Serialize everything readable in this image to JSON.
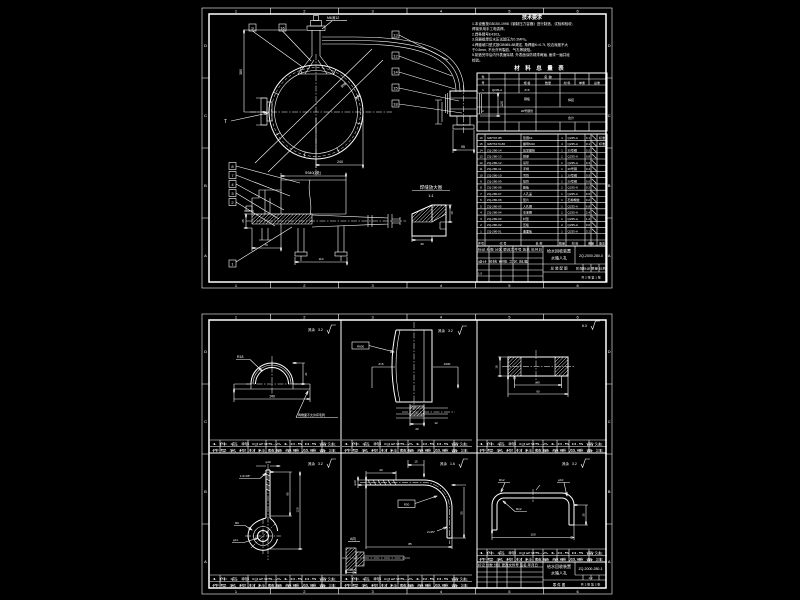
{
  "app": {
    "background": "#000000",
    "line_color": "#ffffff"
  },
  "zones": {
    "h": [
      "1",
      "2",
      "3",
      "4",
      "5",
      "6"
    ],
    "v": [
      "D",
      "C",
      "B",
      "A"
    ]
  },
  "sheet1": {
    "notes": {
      "title": "技术要求",
      "lines": [
        "1.本设备按GB150-1998《钢制压力容器》进行制造、试验和验收;",
        "  焊接采用手工电弧焊。",
        "2.焊条牌号E4303。",
        "3.容器组焊后水压试验压力0.2MPa。",
        "4.焊缝坡口型式按GB985-88规定, 角焊缝K=0.7t, 咬边深度不大",
        "  于0.5mm, 不允许有裂纹、气孔等缺陷。",
        "5.制造完毕后内外表面除锈, 外表面涂防锈漆两遍, 面漆一遍并经",
        "  检验。"
      ]
    },
    "table_title": "材 料 总 量 表",
    "table1": {
      "cells": [
        "件",
        "号",
        "名  称",
        "规 格",
        "数量",
        "材 料",
        "单重",
        "总重",
        "1",
        "Q235-A",
        "δ=6",
        "钢板",
        "焊接",
        "2",
        "20号钢管",
        "合计"
      ]
    },
    "bom": {
      "header": {
        "n": "件号",
        "code": "代  号",
        "name": "名  称",
        "qty": "数量",
        "mat": "材  料",
        "wt": "重量",
        "rem": "备注"
      },
      "rows": [
        {
          "n": "16",
          "code": "GB/T97-85",
          "name": "垫圈10",
          "qty": "4",
          "mat": "Q235-A",
          "w": "0.1",
          "rem": "标准"
        },
        {
          "n": "15",
          "code": "GB/T6170-86",
          "name": "螺母M10",
          "qty": "4",
          "mat": "Q235-A",
          "w": "0.1",
          "rem": "标准"
        },
        {
          "n": "14",
          "code": "ZQ-280-14",
          "name": "压紧螺栓",
          "qty": "1",
          "mat": "35号钢",
          "w": "0.2",
          "rem": ""
        },
        {
          "n": "13",
          "code": "ZQ-280-13",
          "name": "横梁",
          "qty": "1",
          "mat": "Q235-A",
          "w": "0.8",
          "rem": ""
        },
        {
          "n": "12",
          "code": "ZQ-280-12",
          "name": "吊环",
          "qty": "1",
          "mat": "Q235-A",
          "w": "0.3",
          "rem": ""
        },
        {
          "n": "11",
          "code": "ZQ-280-11",
          "name": "手柄",
          "qty": "1",
          "mat": "20号钢",
          "w": "0.4",
          "rem": ""
        },
        {
          "n": "10",
          "code": "ZQ-280-10",
          "name": "弯管",
          "qty": "1",
          "mat": "20号钢",
          "w": "0.5",
          "rem": ""
        },
        {
          "n": "9",
          "code": "ZQ-280-09",
          "name": "接管",
          "qty": "1",
          "mat": "20号钢",
          "w": "0.6",
          "rem": ""
        },
        {
          "n": "8",
          "code": "ZQ-280-08",
          "name": "筋板",
          "qty": "2",
          "mat": "Q235-A",
          "w": "0.2",
          "rem": ""
        },
        {
          "n": "7",
          "code": "ZQ-280-07",
          "name": "人孔盖",
          "qty": "1",
          "mat": "Q235-A",
          "w": "9.5",
          "rem": ""
        },
        {
          "n": "6",
          "code": "ZQ-280-06",
          "name": "垫片",
          "qty": "1",
          "mat": "石棉橡胶",
          "w": "0.2",
          "rem": ""
        },
        {
          "n": "5",
          "code": "ZQ-280-05",
          "name": "人孔圈",
          "qty": "1",
          "mat": "Q235-A",
          "w": "6.8",
          "rem": ""
        },
        {
          "n": "4",
          "code": "ZQ-280-04",
          "name": "支承圈",
          "qty": "1",
          "mat": "Q235-A",
          "w": "2.4",
          "rem": ""
        },
        {
          "n": "3",
          "code": "ZQ-280-03",
          "name": "衬垫",
          "qty": "1",
          "mat": "Q235-A",
          "w": "1.2",
          "rem": ""
        },
        {
          "n": "2",
          "code": "ZQ-280-02",
          "name": "压板",
          "qty": "2",
          "mat": "Q235-A",
          "w": "0.6",
          "rem": ""
        },
        {
          "n": "1",
          "code": "ZQ-280-01",
          "name": "曲面板",
          "qty": "1",
          "mat": "Q235-A",
          "w": "3.1",
          "rem": ""
        }
      ]
    },
    "title_block": {
      "product": "给水回收装置",
      "part": "水箱人孔",
      "view": "总 装 配 图",
      "no": "ZQ-2000-280-0",
      "sig": "标记 处数 分区 更改文件号 签名 年月日",
      "roles": "设计  校核  审核  工艺  批准",
      "stage": "阶段标记  质量  比例",
      "scale": "1:5",
      "sheet": "共 2 张  第 1 张"
    },
    "balloons_top": [
      "9",
      "16"
    ],
    "balloons_right": [
      "13",
      "12",
      "14",
      "15",
      "18"
    ],
    "balloons_left": [
      "8",
      "7",
      "4",
      "3",
      "2"
    ],
    "balloon_bottom": "1",
    "label_t": "T",
    "labels": {
      "thread": "M6深12",
      "weld1": "焊缝",
      "weld2": "满焊"
    },
    "detail": {
      "title": "焊缝放大图",
      "scale": "1:1"
    },
    "dims": {
      "left_h": "380",
      "bot_r": "240",
      "valve_w": "95",
      "valve_h": "120",
      "sec_top": "Φ340(2处)",
      "sec_b1": "70",
      "sec_b2": "110",
      "sec_l": "25",
      "det_w": "30",
      "det_h": "16"
    }
  },
  "sheet2": {
    "strip": {
      "r1": "1  件  名  称  Q235-A  1  0.5  0.5  备注",
      "r2": "件号  名  称  材 料 数量 单重 总重  备  注"
    },
    "fin": {
      "v1": "3.2",
      "v2": "6.3",
      "v3": "1.6",
      "rest": "其余"
    },
    "p1": {
      "r": "R18",
      "h": "21",
      "w": "140",
      "note": "两端面不允许有毛刺"
    },
    "p2": {
      "r": "R600",
      "w": "1000",
      "t": "δ=6",
      "d1": "20",
      "d2": "12"
    },
    "p3": {
      "h": "18",
      "d1": "40",
      "d2": "60"
    },
    "p4": {
      "top": "φ10",
      "cham": "1.6×45°",
      "h1": "95",
      "h2": "120",
      "r": "R9",
      "hole": "φ11"
    },
    "p5": {
      "thr": "20",
      "d": "φ10",
      "top": "15",
      "rad": "R30",
      "cham": "2×45°",
      "h": "55",
      "w": "85",
      "sec": "A向",
      "secd": "20"
    },
    "p6": {
      "r1": "R12",
      "d": "φ10",
      "r2": "R12",
      "w": "150",
      "h": "35"
    },
    "title_block2": {
      "product": "给水回收装置",
      "part": "水箱人孔",
      "view": "零 件 图",
      "no": "ZQ-2000-280-1",
      "sig": "标记 处数 分区 更改文件号 签名 年月日",
      "scale": "1:2",
      "sheet": "共 2 张  第 2 张"
    }
  }
}
